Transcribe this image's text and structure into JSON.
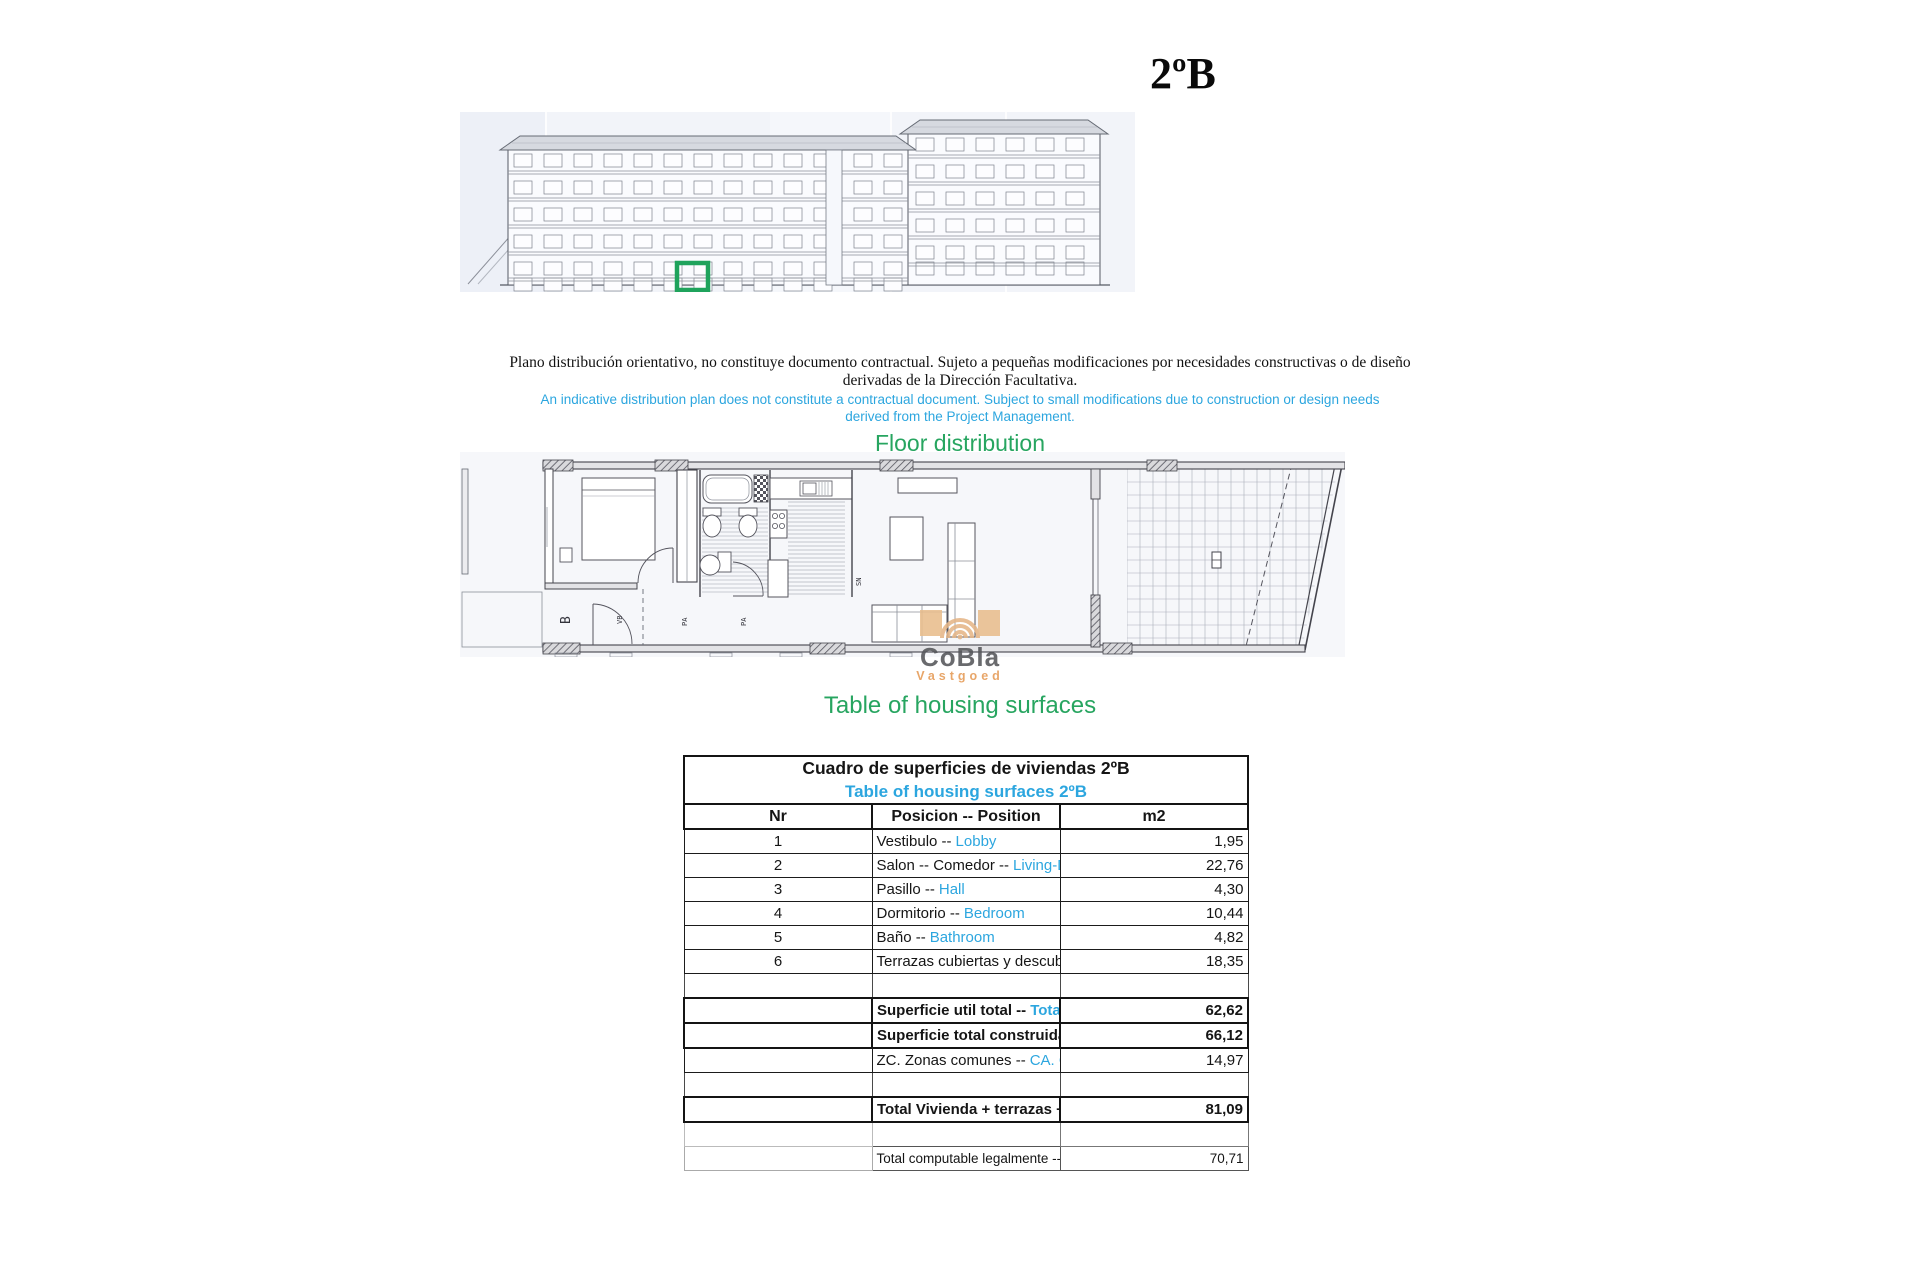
{
  "page": {
    "title": "2ºB"
  },
  "disclaimer": {
    "es_line1": "Plano distribución orientativo, no constituye documento contractual. Sujeto a pequeñas modificaciones por necesidades constructivas o de diseño",
    "es_line2": "derivadas de la Dirección Facultativa.",
    "en_line1": "An indicative distribution plan does not constitute a contractual document. Subject to small modifications due to construction or design needs",
    "en_line2": "derived from the Project Management."
  },
  "headings": {
    "floor_distribution": "Floor distribution",
    "housing_surfaces": "Table of housing surfaces"
  },
  "plan_labels": {
    "b": "B",
    "vb": "VB",
    "pa1": "PA",
    "pa2": "PA",
    "sn": "SN"
  },
  "watermark": {
    "brand": "CoBla",
    "sub": "Vastgoed"
  },
  "colors": {
    "accent_blue": "#2CA6DF",
    "accent_green": "#27A560",
    "highlight_green": "#1FA35C",
    "watermark_orange": "#E5B687"
  },
  "table": {
    "title_es": "Cuadro de superficies de viviendas 2ºB",
    "title_en": "Table of housing surfaces 2ºB",
    "headers": {
      "nr": "Nr",
      "position": "Posicion -- Position",
      "m2": "m2"
    },
    "rows": [
      {
        "nr": "1",
        "es": "Vestibulo --",
        "en": "Lobby",
        "m2": "1,95"
      },
      {
        "nr": "2",
        "es": "Salon -- Comedor --",
        "en": "Living-Dining room",
        "m2": "22,76"
      },
      {
        "nr": "3",
        "es": "Pasillo --",
        "en": "Hall",
        "m2": "4,30"
      },
      {
        "nr": "4",
        "es": "Dormitorio --",
        "en": "Bedroom",
        "m2": "10,44"
      },
      {
        "nr": "5",
        "es": "Baño --",
        "en": "Bathroom",
        "m2": "4,82"
      },
      {
        "nr": "6",
        "es": "Terrazas cubiertas y descubiertas --",
        "en": "Covered and uncovered terraces",
        "m2": "18,35"
      }
    ],
    "summary": [
      {
        "es": "Superficie util total --",
        "en": "Total usable area",
        "m2": "62,62"
      },
      {
        "es": "Superficie total construida --",
        "en": "Vivienda Total built area - Housing",
        "m2": "66,12"
      },
      {
        "es": "ZC. Zonas comunes --",
        "en": "CA. Common areas",
        "m2": "14,97"
      }
    ],
    "total": {
      "es": "Total Vivienda + terrazas + ZC --",
      "en": "Total Housing + terraces + CA",
      "m2": "81,09"
    },
    "legal": {
      "es": "Total computable legalmente --",
      "en": "Total legally computable",
      "m2": "70,71"
    }
  }
}
